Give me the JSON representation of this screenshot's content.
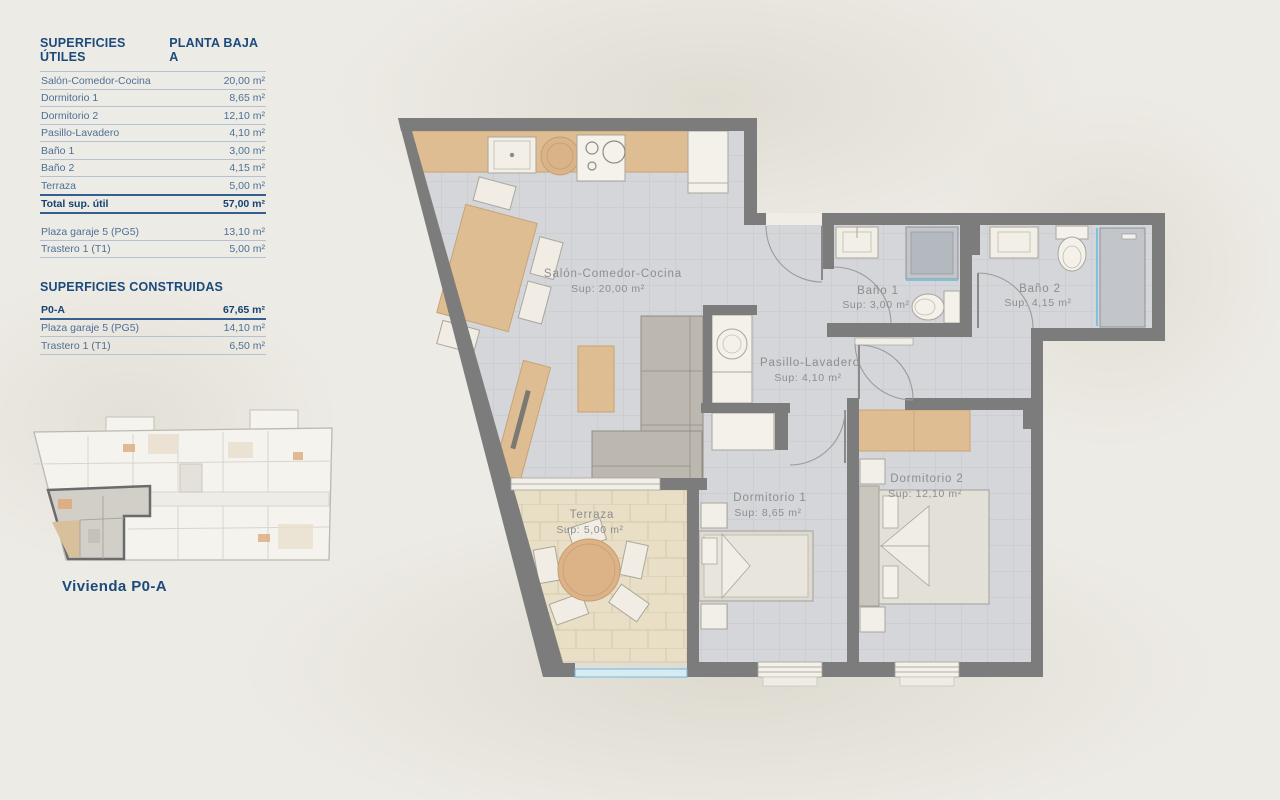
{
  "panel": {
    "title_left": "SUPERFICIES ÚTILES",
    "title_right": "PLANTA BAJA A",
    "utiles_rows": [
      {
        "label": "Salón-Comedor-Cocina",
        "value": "20,00 m²"
      },
      {
        "label": "Dormitorio 1",
        "value": "8,65 m²"
      },
      {
        "label": "Dormitorio 2",
        "value": "12,10 m²"
      },
      {
        "label": "Pasillo-Lavadero",
        "value": "4,10 m²"
      },
      {
        "label": "Baño 1",
        "value": "3,00 m²"
      },
      {
        "label": "Baño 2",
        "value": "4,15 m²"
      },
      {
        "label": "Terraza",
        "value": "5,00 m²"
      }
    ],
    "total_row": {
      "label": "Total sup. útil",
      "value": "57,00 m²"
    },
    "extras_rows": [
      {
        "label": "Plaza garaje 5 (PG5)",
        "value": "13,10 m²"
      },
      {
        "label": "Trastero 1 (T1)",
        "value": "5,00 m²"
      }
    ],
    "construidas_title": "SUPERFICIES CONSTRUIDAS",
    "construidas_rows": [
      {
        "label": "P0-A",
        "value": "67,65 m²"
      },
      {
        "label": "Plaza garaje 5 (PG5)",
        "value": "14,10 m²"
      },
      {
        "label": "Trastero 1 (T1)",
        "value": "6,50 m²"
      }
    ],
    "mini_plan_caption": "Vivienda P0-A"
  },
  "plan": {
    "rooms": [
      {
        "name": "Salón-Comedor-Cocina",
        "sup": "Sup: 20,00 m²"
      },
      {
        "name": "Baño 1",
        "sup": "Sup: 3,00 m²"
      },
      {
        "name": "Baño 2",
        "sup": "Sup: 4,15 m²"
      },
      {
        "name": "Pasillo-Lavadero",
        "sup": "Sup: 4,10 m²"
      },
      {
        "name": "Dormitorio 1",
        "sup": "Sup: 8,65 m²"
      },
      {
        "name": "Dormitorio 2",
        "sup": "Sup: 12,10 m²"
      },
      {
        "name": "Terraza",
        "sup": "Sup: 5,00 m²"
      }
    ]
  },
  "colors": {
    "accent_navy": "#1b4a7b",
    "row_blue": "#4c7097",
    "wall_grey": "#7c7c7c",
    "floor_tile": "#d4d6d9",
    "terrace_tile": "#e8dfc6",
    "wood": "#dfbd92",
    "glass_blue": "#8fcbe4",
    "label_grey": "#8d8d8d",
    "background": "#edebe5"
  }
}
